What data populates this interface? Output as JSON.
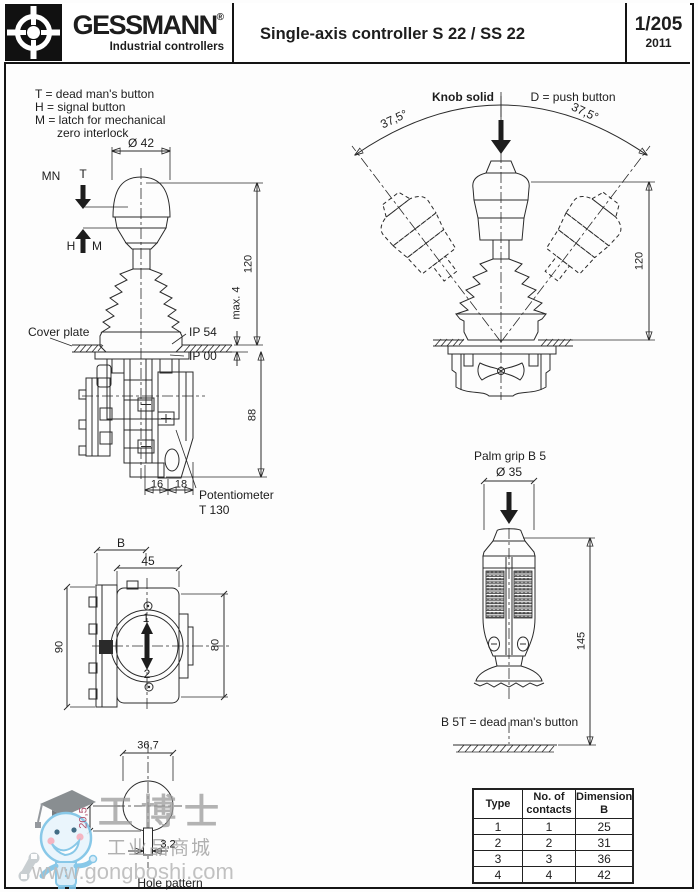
{
  "header": {
    "brand": "GESSMANN",
    "reg": "®",
    "tagline": "Industrial controllers",
    "title": "Single-axis controller S 22 / SS 22",
    "page": "1/205",
    "year": "2011"
  },
  "legend": {
    "l1": "T  = dead man's button",
    "l2": "H = signal button",
    "l3": "M = latch for mechanical",
    "l4": "zero interlock"
  },
  "fig_side_view": {
    "dia": "Ø 42",
    "mn": "MN",
    "t": "T",
    "h": "H",
    "m": "M",
    "cover_plate": "Cover plate",
    "ip54": "IP 54",
    "ip00": "IP 00",
    "d120": "120",
    "max4": "max. 4",
    "d88": "88",
    "d16": "16",
    "d18": "18",
    "pot1": "Potentiometer",
    "pot2": "T 130"
  },
  "fig_deflection": {
    "knob_solid": "Knob solid",
    "push": "D = push button",
    "angle_left": "37,5°",
    "angle_right": "37,5°",
    "d120": "120"
  },
  "fig_front_view": {
    "b": "B",
    "d45": "45",
    "d90": "90",
    "d80": "80",
    "pos1": "1",
    "pos2": "2"
  },
  "fig_hole": {
    "d367": "36,7",
    "d205": "20,5",
    "d32": "3,2",
    "caption": "Hole pattern"
  },
  "fig_grip": {
    "title": "Palm grip B 5",
    "dia": "Ø 35",
    "d145": "145",
    "note": "B 5T = dead man's button"
  },
  "table": {
    "headers": [
      "Type",
      "No. of contacts",
      "Dimension B"
    ],
    "rows": [
      [
        "1",
        "1",
        "25"
      ],
      [
        "2",
        "2",
        "31"
      ],
      [
        "3",
        "3",
        "36"
      ],
      [
        "4",
        "4",
        "42"
      ]
    ]
  },
  "watermark": {
    "name": "工博士",
    "tagline": "工业品商城",
    "url": "www.gongboshi.com"
  }
}
